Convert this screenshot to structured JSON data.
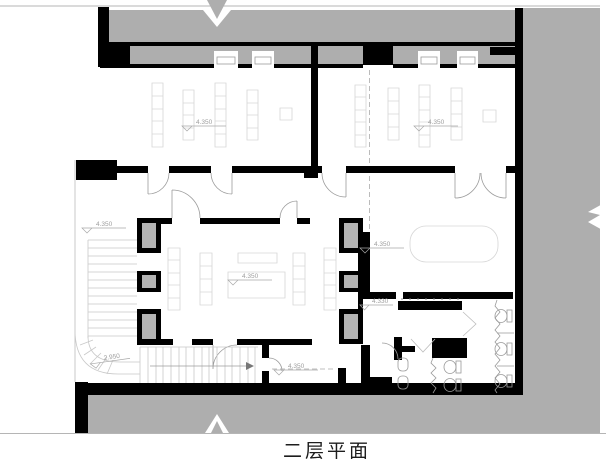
{
  "title": "二层平面",
  "levels": {
    "classroom_left": "4.350",
    "classroom_right": "4.350",
    "stair_landing": "4.350",
    "hall": "4.350",
    "meeting_room": "4.350",
    "washroom_lobby": "4.330",
    "stair_mid_landing": "2.950",
    "rear_vestibule": "4.350"
  },
  "colors": {
    "wall": "#000000",
    "adjacent_shade": "#aeaeae",
    "column_infill": "#b4b4b4",
    "furniture_line": "#d6d6d6",
    "annotation": "#a0a0a0",
    "background": "#ffffff"
  }
}
